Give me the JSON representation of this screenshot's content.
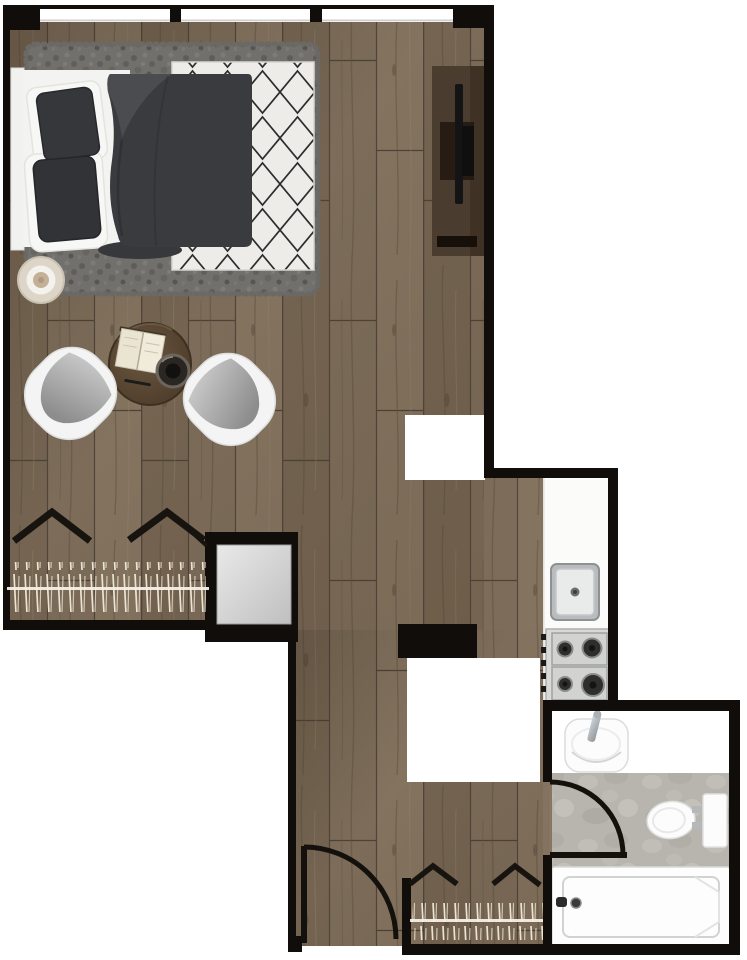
{
  "meta": {
    "description": "Top-down architectural floor plan of a studio apartment",
    "view": "top-down floor plan",
    "visible_text": ""
  },
  "palette": {
    "wall": "#100d0a",
    "exterior": "#ffffff",
    "wood_base": "#7c6c59",
    "wood_dark": "#6f5f4c",
    "wood_light": "#83735f",
    "plank_line": "#51443a",
    "tile": "#b7b5ae",
    "counter": "#fbfbfa",
    "linen": "#f3f3f1",
    "duvet": "#3a3b3e",
    "pillow": "#35373a",
    "shag_rug": "#71706c",
    "diamond_rug_bg": "#edece8",
    "diamond_rug_line": "#2d2d2d",
    "chair_shell": "#f4f4f4",
    "chair_cushion": "#a9a9a9",
    "table_wood": "#5d4935",
    "console_wood": "#4a3c2e",
    "tv": "#141414",
    "stainless": "#d9dad8",
    "fixture_white": "#fcfcfc",
    "closet_mirror": "#d9d9d9",
    "curtain_symbol": "#17130e",
    "radiator_hatch": "#ece4d2"
  },
  "rooms": [
    {
      "id": "living-sleeping",
      "label": "Living and sleeping area"
    },
    {
      "id": "kitchen",
      "label": "Kitchenette"
    },
    {
      "id": "bathroom",
      "label": "Bathroom"
    },
    {
      "id": "entry",
      "label": "Entry hall"
    },
    {
      "id": "wardrobe",
      "label": "Built-in wardrobe"
    }
  ],
  "labels": {
    "floor_plan": "Studio apartment floor plan",
    "bed": "Double bed with dark duvet and pillows",
    "headboard": "Headboard",
    "shag_rug": "Gray shag rug under bed",
    "diamond_rug": "White rug with black diamond lattice",
    "side_table": "Round side table",
    "tv_console": "TV console",
    "tv": "Television",
    "chair_left": "Lounge chair left",
    "chair_right": "Lounge chair right",
    "coffee_table": "Round coffee table",
    "book": "Open book",
    "bowl": "Decorative bowl",
    "pen": "Pen",
    "wardrobe": "Mirrored wardrobe",
    "kitchen_counter": "Kitchen counter",
    "kitchen_sink": "Kitchen sink",
    "gas_hob": "Gas hob with four burners",
    "bathroom_sink": "Bathroom washbasin",
    "toilet": "Toilet",
    "bathtub": "Bathtub",
    "entry_door": "Entry door with swing arc",
    "bathroom_door": "Bathroom door with swing arc",
    "windows": "Window band with three panes",
    "curtains": "Curtain chevron symbols",
    "radiator": "Radiator hatch symbol",
    "walls": "Exterior and interior walls"
  },
  "counts": {
    "windows_top": 3,
    "doors": 2,
    "hob_burners": 4,
    "lounge_chairs": 2,
    "curtain_chevrons": 4
  }
}
